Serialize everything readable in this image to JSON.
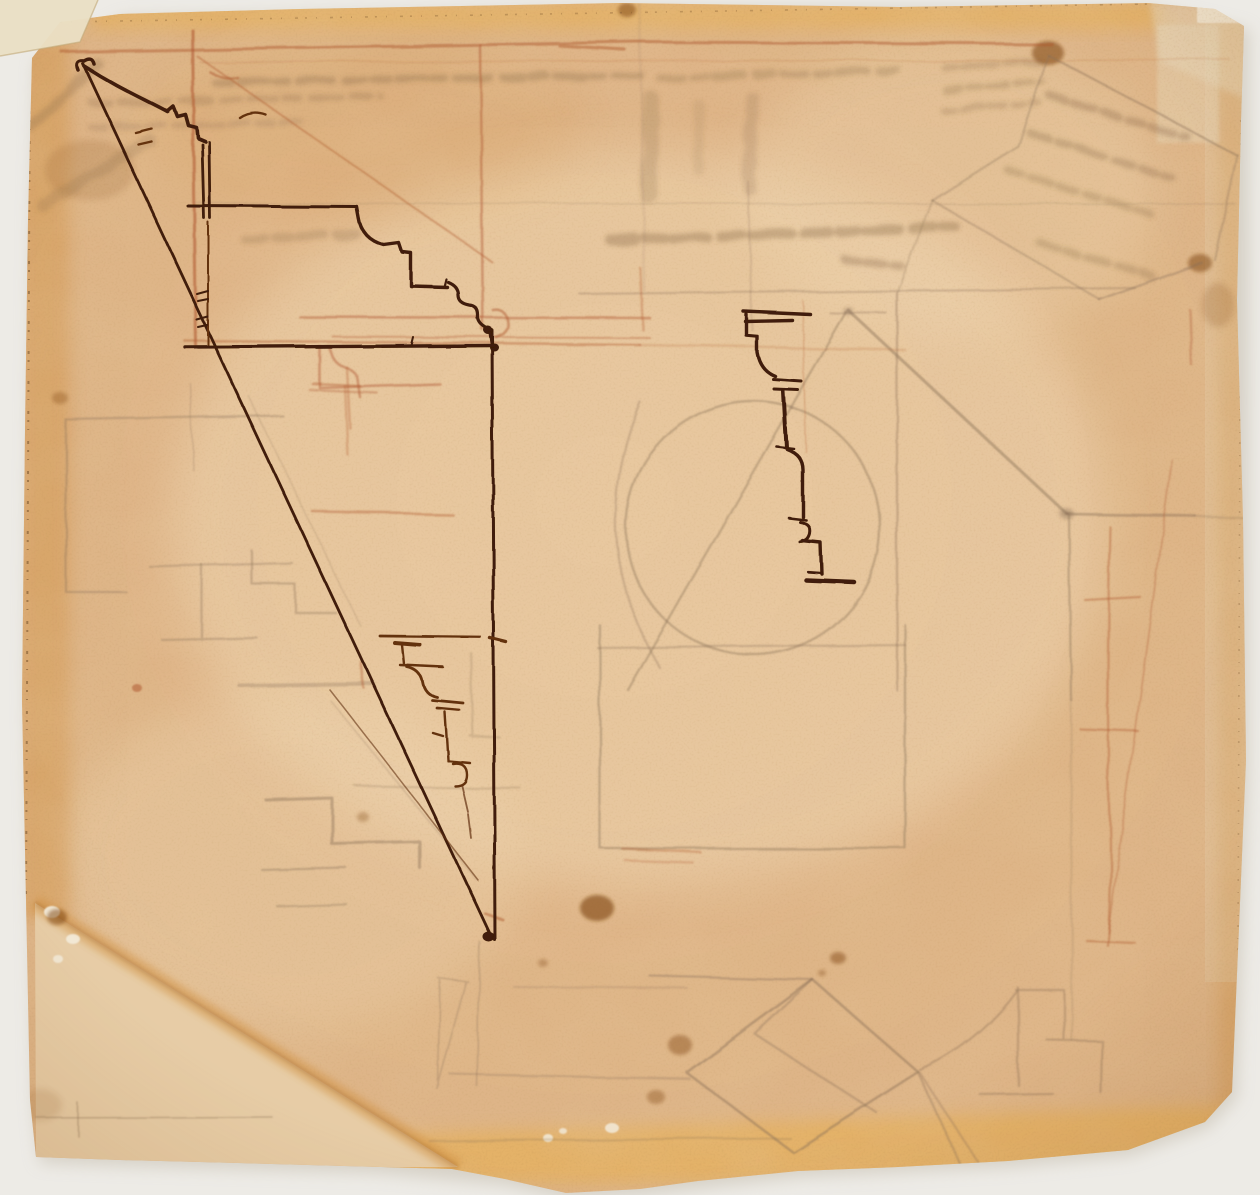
{
  "artwork": {
    "kind": "photograph of an aged architectural drawing sheet",
    "media": [
      "dark brown ink",
      "red chalk",
      "graphite"
    ],
    "legible_text": "",
    "figures": [
      {
        "name": "large-crown-cornice-profile",
        "medium": "ink"
      },
      {
        "name": "stepped-cornice-profile-with-ogee",
        "medium": "ink"
      },
      {
        "name": "long-construction-diagonal",
        "medium": "ink"
      },
      {
        "name": "central-vertical-cornice-profile",
        "medium": "ink"
      },
      {
        "name": "small-cornice-profile",
        "medium": "ink"
      },
      {
        "name": "red-chalk-frame-lines",
        "medium": "chalk"
      },
      {
        "name": "circle-in-square-plan-sketch",
        "medium": "graphite"
      },
      {
        "name": "roof-pentagon-sketch",
        "medium": "graphite"
      },
      {
        "name": "stepped-plan-fragments-left",
        "medium": "graphite"
      },
      {
        "name": "folded-strip-sketch-top-right",
        "medium": "graphite"
      },
      {
        "name": "diamond-box-sketch-bottom",
        "medium": "graphite"
      },
      {
        "name": "mirror-writing-offset-ghost-text",
        "medium": "ink offset"
      },
      {
        "name": "torn-corner-with-repair-patch",
        "medium": "paper"
      },
      {
        "name": "ruled-line-with-cross-tick",
        "medium": "graphite"
      }
    ]
  },
  "palette": {
    "bg": "#edebe6",
    "shadow": "#c3bbac",
    "paper": "#e0b78a",
    "paper_light": "#f1dab6",
    "edge": "#d2913f",
    "band": "#eab254",
    "patch": "#e9cfa9",
    "tape": "#eadfc4",
    "chip": "#f5efdf",
    "ink": "#3f1d07",
    "ink2": "#63300f",
    "chalk": "#b25c33",
    "graphite": "#8a7058",
    "ghost": "#7a5a3a",
    "stain": "#7c420f",
    "vignette": "#8c551e"
  }
}
